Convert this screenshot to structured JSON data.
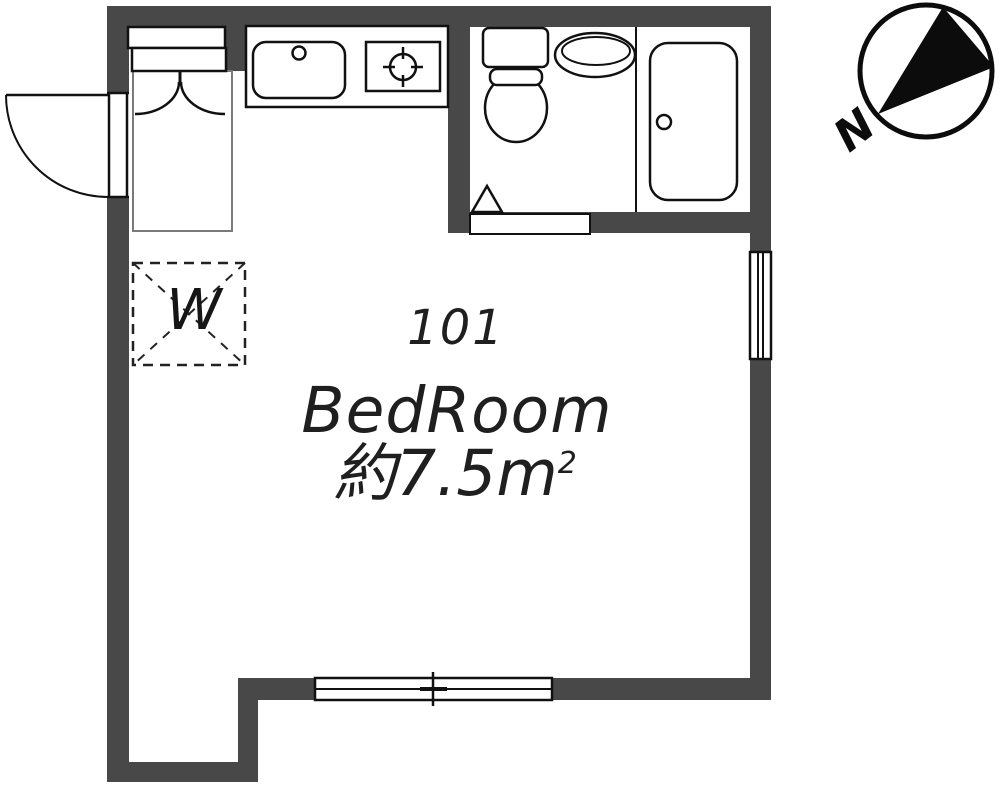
{
  "floor_plan": {
    "room_number": "101",
    "room_name": "BedRoom",
    "room_area_prefix": "約7.5m",
    "room_area_superscript": "2",
    "washer_label": "W",
    "compass_label": "N"
  },
  "colors": {
    "wall": "#484848",
    "line": "#111111",
    "text": "#1f1f1f",
    "bed_outline": "#7a7a7a",
    "background": "#ffffff"
  },
  "fixtures": [
    "entry-door",
    "bed",
    "kitchen-counter",
    "kitchen-sink",
    "stove-burner",
    "toilet",
    "wash-basin",
    "bathtub",
    "bathroom-door-step",
    "door-swing-triangle",
    "washing-machine-area",
    "window-east",
    "window-south",
    "compass-north"
  ]
}
